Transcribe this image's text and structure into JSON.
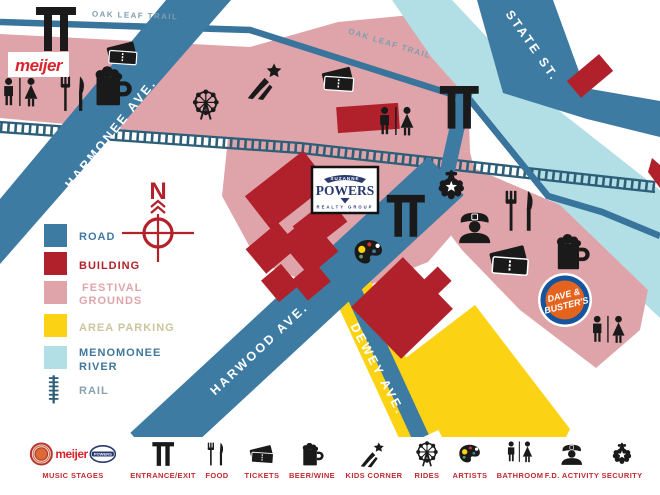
{
  "map": {
    "streets": {
      "harmonee": "HARMONEE AVE.",
      "state": "STATE ST.",
      "harwood": "HARWOOD AVE.",
      "dewey": "DEWEY AVE."
    },
    "trail": {
      "label_left": "OAK LEAF TRAIL",
      "label_right": "OAK LEAF TRAIL"
    },
    "compass": {
      "label": "N"
    },
    "logos": {
      "meijer": "meijer",
      "powers": {
        "top": "SUZANNE",
        "name": "POWERS",
        "sub": "REALTY  GROUP"
      },
      "daveandbusters": {
        "line1": "DAVE &",
        "line2": "BUSTER'S"
      },
      "powers_small": "POWERS"
    }
  },
  "legend": {
    "items": [
      {
        "label": "ROAD",
        "color": "#3d7ba3",
        "text_color": "#3d7ba3"
      },
      {
        "label": "BUILDING",
        "color": "#b1212b",
        "text_color": "#b1212b"
      },
      {
        "label": "FESTIVAL",
        "label2": "GROUNDS",
        "color": "#dfa4aa",
        "text_color": "#dfa4aa"
      },
      {
        "label": "AREA PARKING",
        "color": "#fcd215",
        "text_color": "#cdc49c"
      },
      {
        "label": "MENOMONEE",
        "label2": "RIVER",
        "color": "#b2dfe6",
        "text_color": "#41779c"
      },
      {
        "label": "RAIL",
        "color": "#2e5f79",
        "text_color": "#8aa2b0"
      }
    ]
  },
  "bottom_legend": {
    "items": [
      {
        "label": "MUSIC STAGES"
      },
      {
        "label": "ENTRANCE/EXIT"
      },
      {
        "label": "FOOD"
      },
      {
        "label": "TICKETS"
      },
      {
        "label": "BEER/WINE"
      },
      {
        "label": "KIDS CORNER"
      },
      {
        "label": "RIDES"
      },
      {
        "label": "ARTISTS"
      },
      {
        "label": "BATHROOM"
      },
      {
        "label": "F.D. ACTIVITY"
      },
      {
        "label": "SECURITY"
      }
    ]
  },
  "colors": {
    "road": "#3d7ba3",
    "building": "#b1212b",
    "festival_grounds": "#dfa4aa",
    "area_parking": "#fcd215",
    "menomonee_river": "#b2dfe6",
    "rail": "#2e5f79",
    "bottom_label_red": "#c22a30",
    "trail_text": "#7f9dad",
    "compass_red": "#b3222b",
    "meijer_red": "#d8262e",
    "powers_navy": "#2a3a6e",
    "dnb_blue": "#17549e",
    "dnb_orange": "#e4641f"
  }
}
